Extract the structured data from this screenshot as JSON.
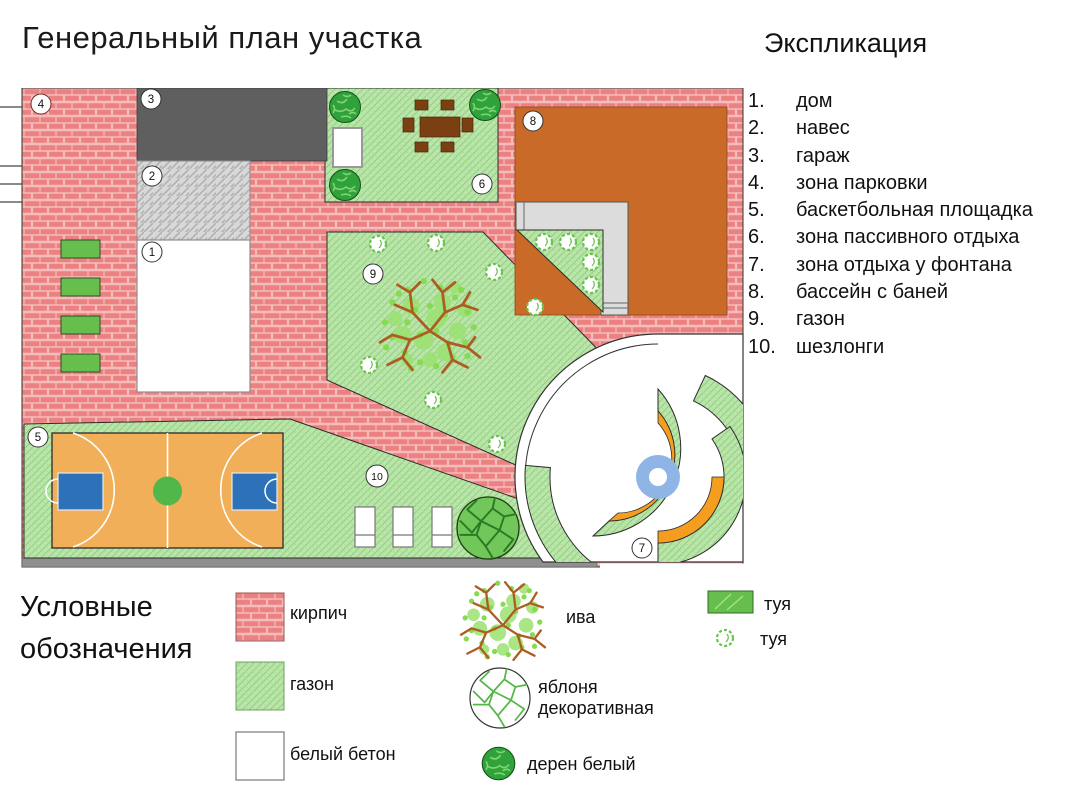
{
  "title": "Генеральный план участка",
  "explication": {
    "heading": "Экспликация",
    "items": [
      {
        "num": "1.",
        "label": "дом"
      },
      {
        "num": "2.",
        "label": "навес"
      },
      {
        "num": "3.",
        "label": "гараж"
      },
      {
        "num": "4.",
        "label": "зона парковки"
      },
      {
        "num": "5.",
        "label": "баскетбольная площадка"
      },
      {
        "num": "6.",
        "label": "зона пассивного отдыха"
      },
      {
        "num": "7.",
        "label": "зона отдыха у фонтана"
      },
      {
        "num": "8.",
        "label": "бассейн с баней"
      },
      {
        "num": "9.",
        "label": "газон"
      },
      {
        "num": "10.",
        "label": "шезлонги"
      }
    ]
  },
  "legend": {
    "heading": "Условные обозначения",
    "materials": [
      {
        "icon": "brick-swatch-icon",
        "label": "кирпич"
      },
      {
        "icon": "lawn-swatch-icon",
        "label": "газон"
      },
      {
        "icon": "white-concrete-swatch-icon",
        "label": "белый бетон"
      }
    ],
    "plants": [
      {
        "icon": "willow-icon",
        "label": "ива"
      },
      {
        "icon": "apple-tree-icon",
        "label": "яблоня декоративная"
      },
      {
        "icon": "dogwood-icon",
        "label": "дерен белый"
      },
      {
        "icon": "thuja-hedge-icon",
        "label": "туя"
      },
      {
        "icon": "thuja-circle-icon",
        "label": "туя"
      }
    ]
  },
  "plan": {
    "badges": [
      {
        "number": "1"
      },
      {
        "number": "2"
      },
      {
        "number": "3"
      },
      {
        "number": "4"
      },
      {
        "number": "5"
      },
      {
        "number": "6"
      },
      {
        "number": "7"
      },
      {
        "number": "8"
      },
      {
        "number": "9"
      },
      {
        "number": "10"
      }
    ],
    "colors": {
      "brick": "#eb8181",
      "lawn": "#a9dc9a",
      "garage": "#5f5f5f",
      "canopy": "#d8d8d8",
      "house": "#ffffff",
      "pool_bath": "#c96a28",
      "terrace": "#dcdcdc",
      "court": "#f2af5a",
      "court_key": "#2d72b8",
      "court_center": "#51b748",
      "fountain_water": "#8eb5e5",
      "fountain_arc": "#f59d1e",
      "hedge_green": "#66bf4d",
      "tree_dark": "#2fa23b"
    }
  }
}
